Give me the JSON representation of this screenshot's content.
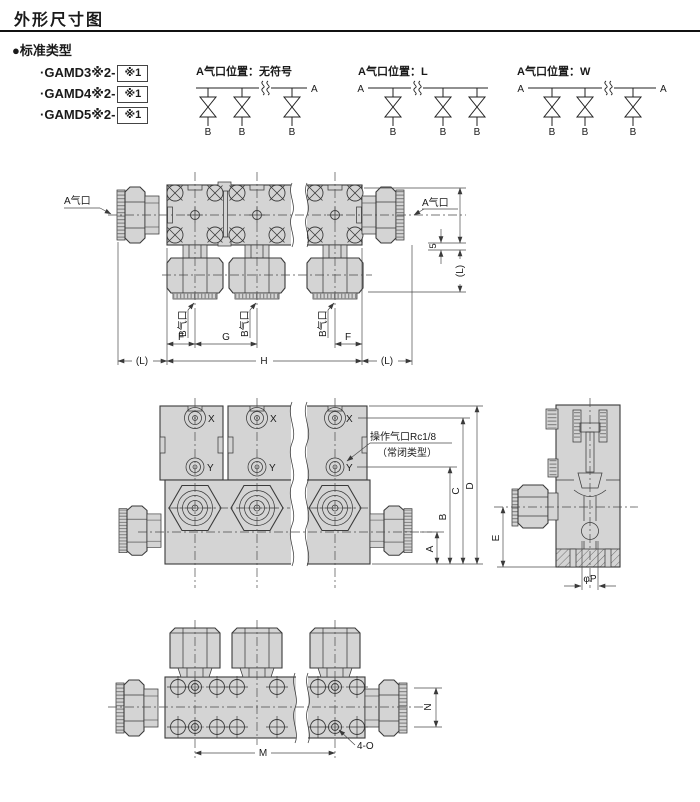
{
  "page": {
    "title": "外形尺寸图"
  },
  "standard_type": {
    "heading": "●标准类型",
    "models": [
      {
        "name": "·GAMD3※2-",
        "suffix": "※1"
      },
      {
        "name": "·GAMD4※2-",
        "suffix": "※1"
      },
      {
        "name": "·GAMD5※2-",
        "suffix": "※1"
      }
    ]
  },
  "schematics": {
    "none": {
      "title": "A气口位置：无符号"
    },
    "l": {
      "title": "A气口位置：L"
    },
    "w": {
      "title": "A气口位置：W"
    },
    "port_a": "A",
    "port_b": "B"
  },
  "labels": {
    "a_port": "A气口",
    "b_port": "B气口",
    "pilot_port_line1": "操作气口Rc1/8",
    "pilot_port_line2": "（常闭类型）",
    "x": "X",
    "y": "Y"
  },
  "dims": {
    "f": "F",
    "g": "G",
    "h": "H",
    "l": "(L)",
    "five": "5",
    "a": "A",
    "b": "B",
    "c": "C",
    "d": "D",
    "e": "E",
    "p": "φP",
    "m": "M",
    "n": "N",
    "o": "4-O"
  },
  "colors": {
    "body_fill": "#d4d4d4",
    "line": "#3a3a3a",
    "dim_line": "#4a4a4a",
    "text": "#1a1a1a"
  }
}
